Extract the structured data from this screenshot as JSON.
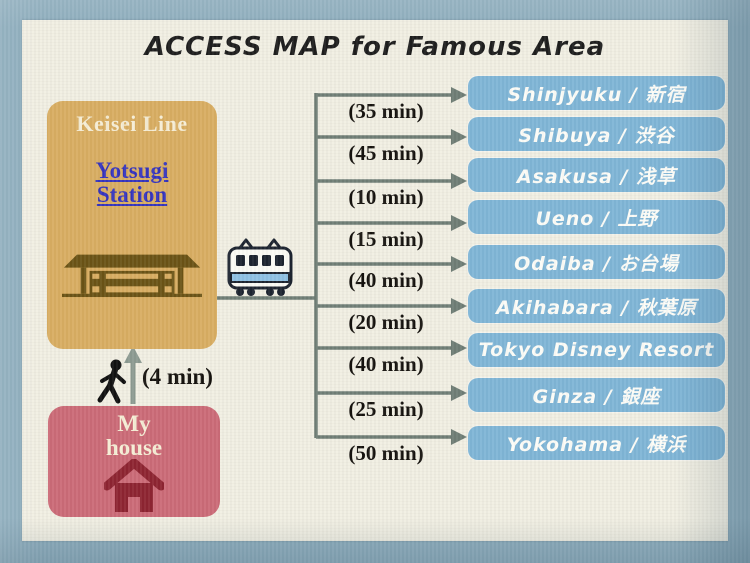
{
  "title": "ACCESS MAP for Famous Area",
  "station": {
    "line_name": "Keisei Line",
    "name_line1": "Yotsugi",
    "name_line2": "Station"
  },
  "house": {
    "label_line1": "My",
    "label_line2": "house"
  },
  "walk": {
    "duration_label": "(4 min)"
  },
  "destinations": [
    {
      "name": "Shinjyuku / 新宿",
      "time": "(35 min)"
    },
    {
      "name": "Shibuya / 渋谷",
      "time": "(45 min)"
    },
    {
      "name": "Asakusa / 浅草",
      "time": "(10 min)"
    },
    {
      "name": "Ueno / 上野",
      "time": "(15 min)"
    },
    {
      "name": "Odaiba / お台場",
      "time": "(40 min)"
    },
    {
      "name": "Akihabara / 秋葉原",
      "time": "(20 min)"
    },
    {
      "name": "Tokyo Disney Resort",
      "time": "(40 min)"
    },
    {
      "name": "Ginza / 銀座",
      "time": "(25 min)"
    },
    {
      "name": "Yokohama / 横浜",
      "time": "(50 min)"
    }
  ],
  "icons": {
    "train": "train-icon",
    "station_building": "station-building-icon",
    "house": "house-icon",
    "walking_person": "walking-person-icon",
    "branch_arrow": "arrow-right-icon",
    "walk_arrow": "arrow-up-icon"
  },
  "colors": {
    "background": "#8FAEBE",
    "panel": "#F1EFE3",
    "station_box": "#D8AD62",
    "station_link": "#3534BE",
    "house_box": "#CB6B77",
    "house_icon": "#8E2532",
    "destination_box": "#7FB5D6",
    "connector_line": "#6F7D75",
    "walk_arrow": "#8C9A91",
    "text_dark": "#1E1E1E",
    "text_cream": "#F5EDD5"
  }
}
